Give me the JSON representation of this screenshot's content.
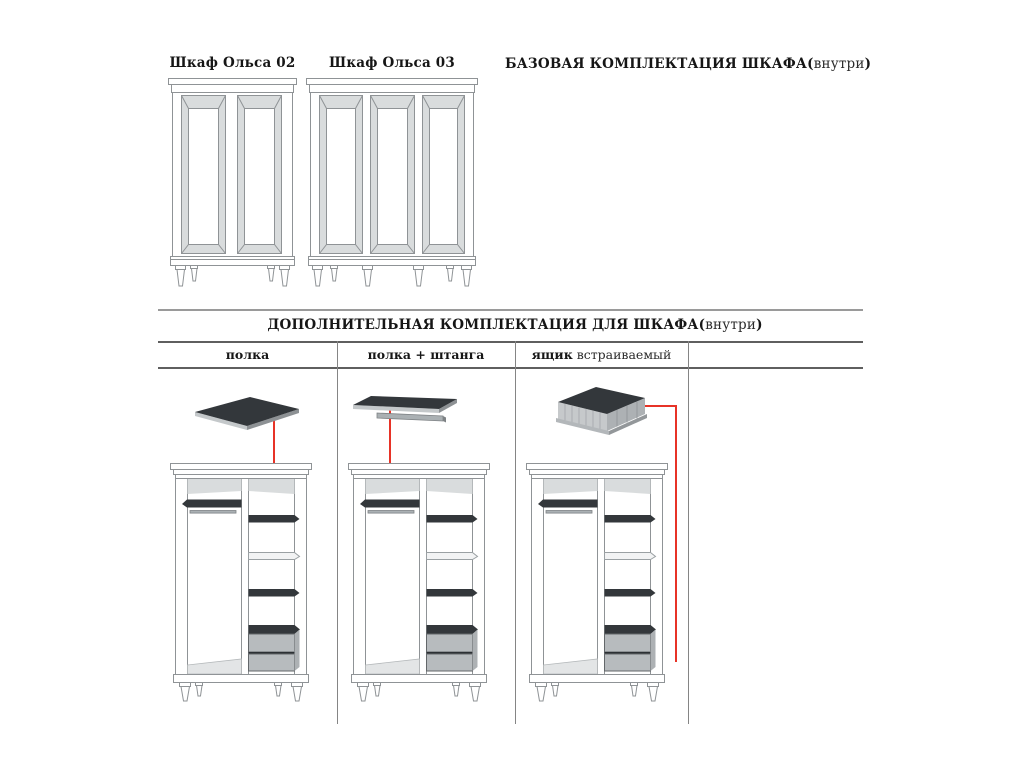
{
  "basic_section": {
    "wardrobe_02_label": "Шкаф Ольса 02",
    "wardrobe_03_label": "Шкаф Ольса 03",
    "title_main": "БАЗОВАЯ КОМПЛЕКТАЦИЯ ШКАФА",
    "paren_open": "(",
    "title_inner": "внутри",
    "paren_close": ")"
  },
  "additional_section": {
    "title_main": "ДОПОЛНИТЕЛЬНАЯ КОМПЛЕКТАЦИЯ ДЛЯ ШКАФА",
    "paren_open": "(",
    "title_inner": "внутри",
    "paren_close": ")",
    "columns": [
      {
        "bold": "полка",
        "regular": ""
      },
      {
        "bold": "полка + штанга",
        "regular": ""
      },
      {
        "bold": "ящик",
        "regular": " встраиваемый"
      },
      {
        "bold": "",
        "regular": ""
      }
    ]
  },
  "colors": {
    "annotation_red": "#e73327",
    "shelf_dark": "#33373b",
    "bevel_gray": "#d9dcdd",
    "drawer_gray": "#b7bbbe",
    "outline_gray": "#8f9396",
    "table_line": "#6e6e6e",
    "floor_gray": "#e3e5e6",
    "rod_gray": "#aab0b3",
    "text_black": "#161616"
  }
}
